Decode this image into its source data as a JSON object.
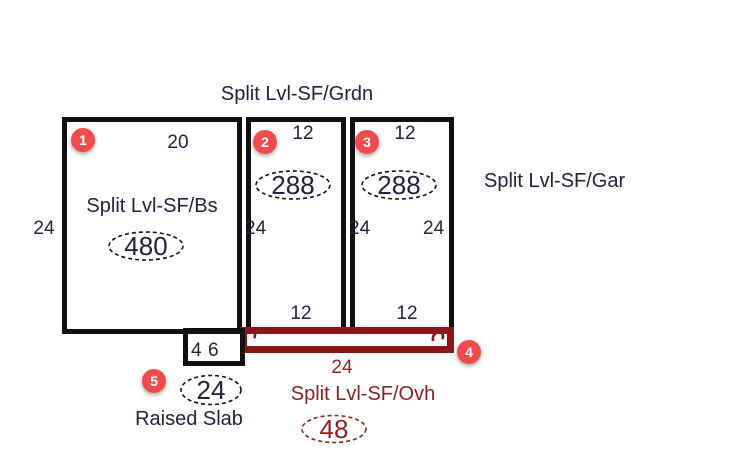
{
  "colors": {
    "ink_text": "#22223a",
    "maroon_text": "#8B2323",
    "overhang_border": "#8B1616",
    "wall_border": "#111111",
    "marker_red": "#F24B4B",
    "marker_number": "#ffffff",
    "background": "#ffffff"
  },
  "sketch": {
    "header_label": "Split Lvl-SF/Grdn",
    "basement": {
      "label": "Split Lvl-SF/Bs",
      "area": "480",
      "top_dim": "20",
      "left_dim": "24"
    },
    "garden_left": {
      "area": "288",
      "top_dim": "12",
      "left_dim": "24",
      "bottom_dim": "12"
    },
    "garden_right": {
      "area": "288",
      "top_dim": "12",
      "left_dim": "24",
      "right_dim": "24",
      "bottom_dim": "12"
    },
    "garage_label": "Split Lvl-SF/Gar",
    "overhang": {
      "label": "Split Lvl-SF/Ovh",
      "area": "48",
      "width_dim": "24"
    },
    "raised_slab": {
      "label": "Raised Slab",
      "area": "24",
      "dim_a": "4",
      "dim_b": "6"
    }
  },
  "markers": {
    "m1": "1",
    "m2": "2",
    "m3": "3",
    "m4": "4",
    "m5": "5"
  }
}
